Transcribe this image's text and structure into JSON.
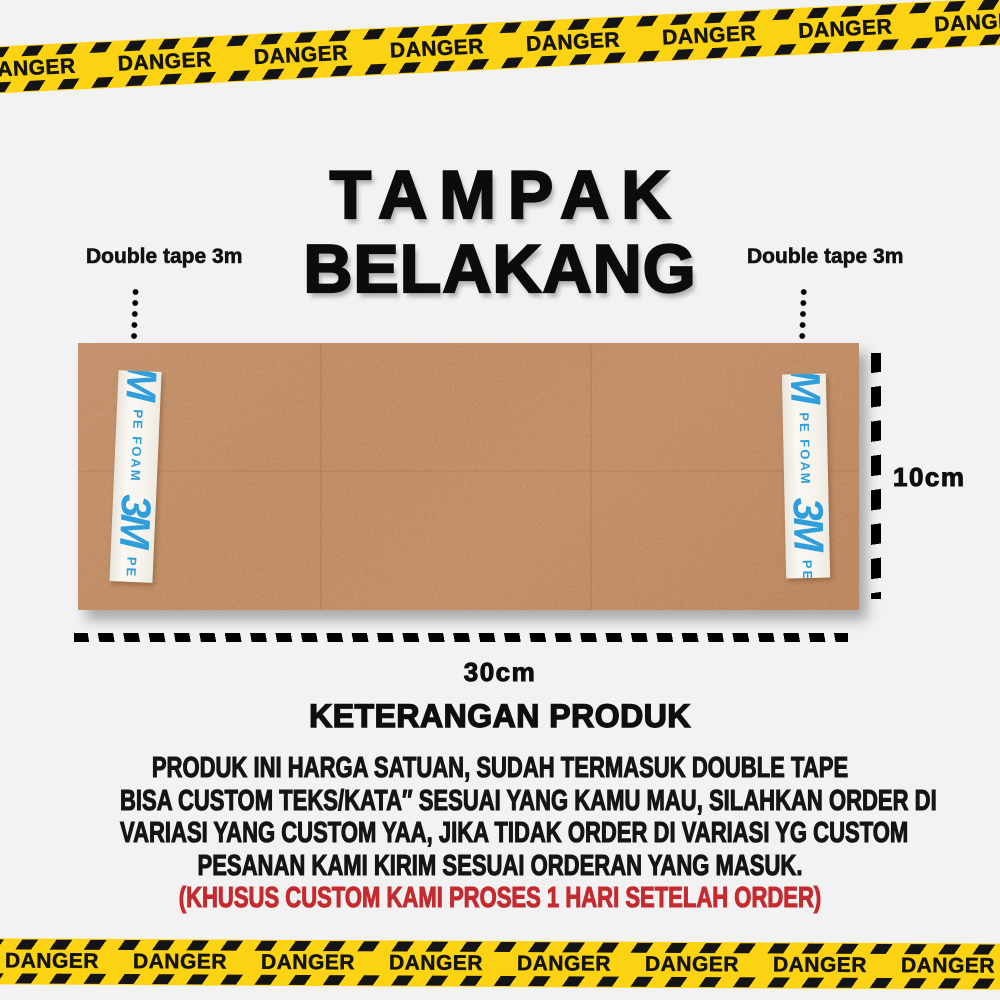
{
  "page": {
    "background": "#F3F2F2"
  },
  "danger_tape": {
    "label": "DANGER",
    "tape_yellow": "#FBD312",
    "stripe_black": "#141414"
  },
  "title": {
    "line1": "TAMPAK",
    "line2": "BELAKANG"
  },
  "annotations": {
    "left_tape_label": "Double tape 3m",
    "right_tape_label": "Double tape 3m",
    "height_dim": "10cm",
    "width_dim": "30cm"
  },
  "board": {
    "color": "#CE9368",
    "tape_strip": {
      "brand": "3M",
      "material": "PE FOAM",
      "text_color": "#2E9FDA",
      "bg": "#F7F5F0"
    }
  },
  "product_info": {
    "heading": "KETERANGAN PRODUK",
    "lines": [
      "PRODUK INI HARGA SATUAN, SUDAH TERMASUK DOUBLE TAPE",
      "BISA CUSTOM TEKS/KATA″ SESUAI YANG KAMU MAU, SILAHKAN ORDER DI",
      "VARIASI YANG CUSTOM YAA, JIKA TIDAK ORDER DI VARIASI YG CUSTOM",
      "PESANAN KAMI KIRIM SESUAI ORDERAN YANG MASUK."
    ],
    "highlight": "(KHUSUS CUSTOM KAMI PROSES 1 HARI SETELAH ORDER)",
    "highlight_color": "#C42A2E"
  }
}
